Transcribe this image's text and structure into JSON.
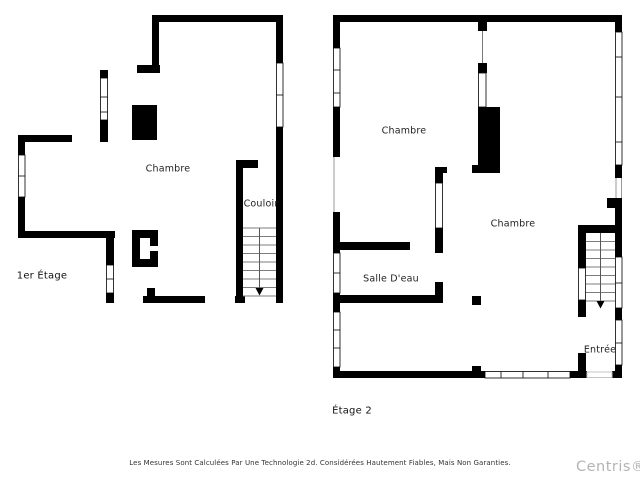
{
  "page": {
    "disclaimer": "Les Mesures Sont Calculées Par Une Technologie 2d. Considérées Hautement Fiables, Mais Non Garanties.",
    "watermark": "Centris®"
  },
  "floor1": {
    "name": "1er Étage",
    "labels": {
      "chambre": "Chambre",
      "couloir": "Couloir"
    }
  },
  "floor2": {
    "name": "Étage 2",
    "labels": {
      "chambre_top": "Chambre",
      "chambre_right": "Chambre",
      "salle_deau": "Salle D'eau",
      "entree": "Entrée"
    }
  },
  "colors": {
    "wall": "#000000",
    "window_stroke": "#000000",
    "stair_lines": "#7d7d7d",
    "label_text": "#1f1f1f",
    "watermark": "#b4b4b4"
  }
}
